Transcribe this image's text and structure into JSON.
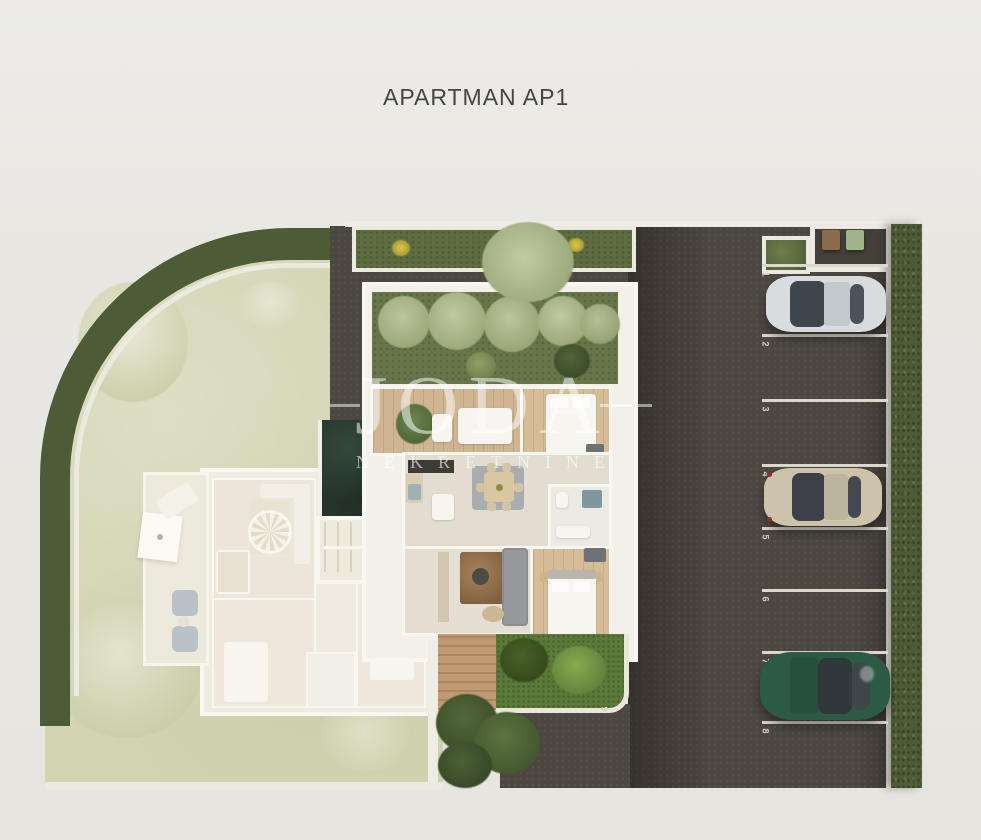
{
  "title": "APARTMAN AP1",
  "watermark": {
    "brand": "JODA",
    "subtitle": "NEKRETNINE"
  },
  "site": {
    "parking": {
      "space_numbers": [
        "1",
        "2",
        "3",
        "4",
        "5",
        "6",
        "7",
        "8"
      ],
      "side_space_number": "9",
      "asphalt_color": "#4d4741",
      "line_color": "#dcd8cc",
      "cars": [
        {
          "name": "silver-car",
          "space": "1",
          "body_color": "#d9dcde"
        },
        {
          "name": "beige-car",
          "space": "4",
          "body_color": "#cdc3aa"
        },
        {
          "name": "green-car",
          "space": "7",
          "body_color": "#2d5a44"
        }
      ],
      "bins": [
        {
          "name": "brown-bin",
          "color": "#8a6e4c"
        },
        {
          "name": "green-bin",
          "color": "#9fb38a"
        }
      ]
    },
    "colors": {
      "background": "#e9e7e2",
      "hedge": "#4c5c36",
      "lawn": "#d2d4b2",
      "courtyard_green": "#66764a",
      "garden_patch_green": "#5b7a39",
      "wood_floor": "#d6bd98",
      "deck_wood": "#c09a73",
      "wall_white": "#f8f6f0"
    }
  }
}
